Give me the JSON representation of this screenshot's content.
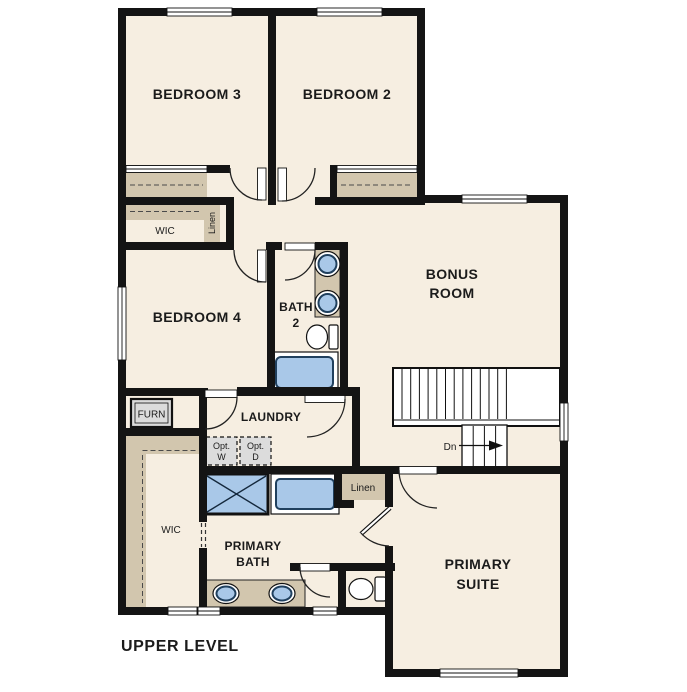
{
  "floor_plan": {
    "title": "UPPER LEVEL",
    "rooms": {
      "bedroom_3": {
        "label": "BEDROOM 3"
      },
      "bedroom_2": {
        "label": "BEDROOM 2"
      },
      "bedroom_4": {
        "label": "BEDROOM 4"
      },
      "bath_2": {
        "label_line1": "BATH",
        "label_line2": "2"
      },
      "bonus_room": {
        "label_line1": "BONUS",
        "label_line2": "ROOM"
      },
      "laundry": {
        "label": "LAUNDRY"
      },
      "primary_bath": {
        "label_line1": "PRIMARY",
        "label_line2": "BATH"
      },
      "primary_suite": {
        "label_line1": "PRIMARY",
        "label_line2": "SUITE"
      }
    },
    "closets": {
      "wic_upper": {
        "label": "WIC"
      },
      "wic_lower": {
        "label": "WIC"
      },
      "linen_upper": {
        "label": "Linen"
      },
      "linen_lower": {
        "label": "Linen"
      }
    },
    "equipment": {
      "furnace": {
        "label": "FURN"
      },
      "optional_washer": {
        "label_line1": "Opt.",
        "label_line2": "W"
      },
      "optional_dryer": {
        "label_line1": "Opt.",
        "label_line2": "D"
      }
    },
    "stairs": {
      "direction_label": "Dn"
    },
    "colors": {
      "floor": "#f6eee1",
      "wall": "#141414",
      "closet_shelf": "#d2c6ae",
      "fixture_blue": "#a9c8e8",
      "fixture_outline": "#20405e",
      "equipment_gray": "#dcdcdc"
    }
  }
}
